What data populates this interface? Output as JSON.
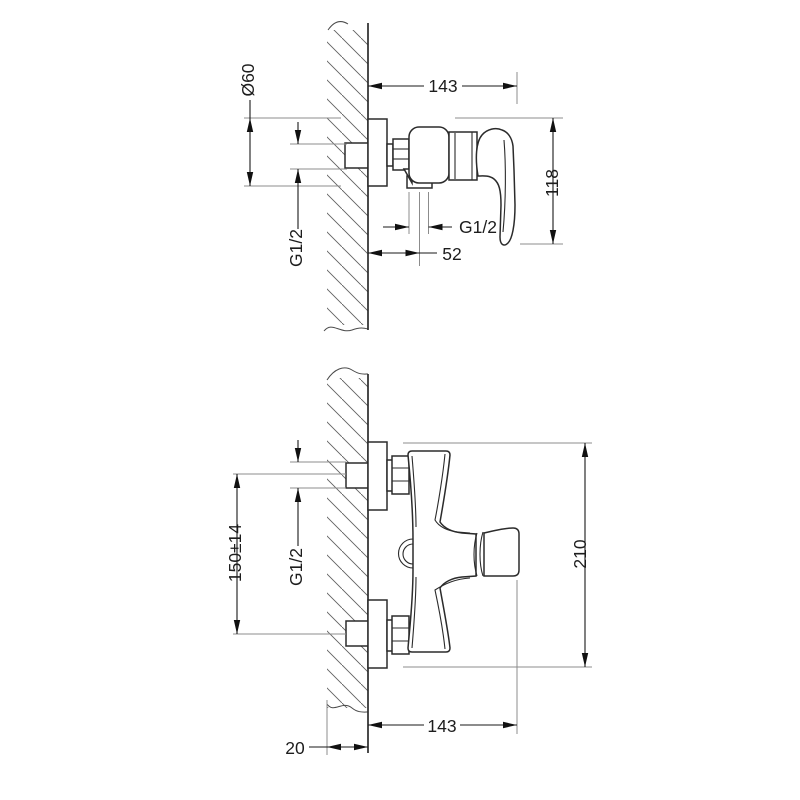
{
  "views": {
    "side_view": {
      "name": "side view (section through wall)",
      "dimensions": {
        "escutcheon_diameter": "Ø60",
        "depth_from_wall": "143",
        "body_height": "118",
        "wall_inlet_thread": "G1/2",
        "outlet_thread": "G1/2",
        "outlet_distance_from_wall": "52"
      }
    },
    "front_view": {
      "name": "front view",
      "dimensions": {
        "inlet_center_distance": "150±14",
        "inlet_thread": "G1/2",
        "overall_height": "210",
        "depth_from_wall": "143",
        "wall_reference_offset": "20"
      }
    }
  },
  "colors": {
    "background": "#ffffff",
    "object_line": "#2b2b2b",
    "dimension_line": "#1a1a1a",
    "extension_line": "#8c8c8c",
    "hatch_line": "#606060",
    "text": "#1d1d1d"
  }
}
